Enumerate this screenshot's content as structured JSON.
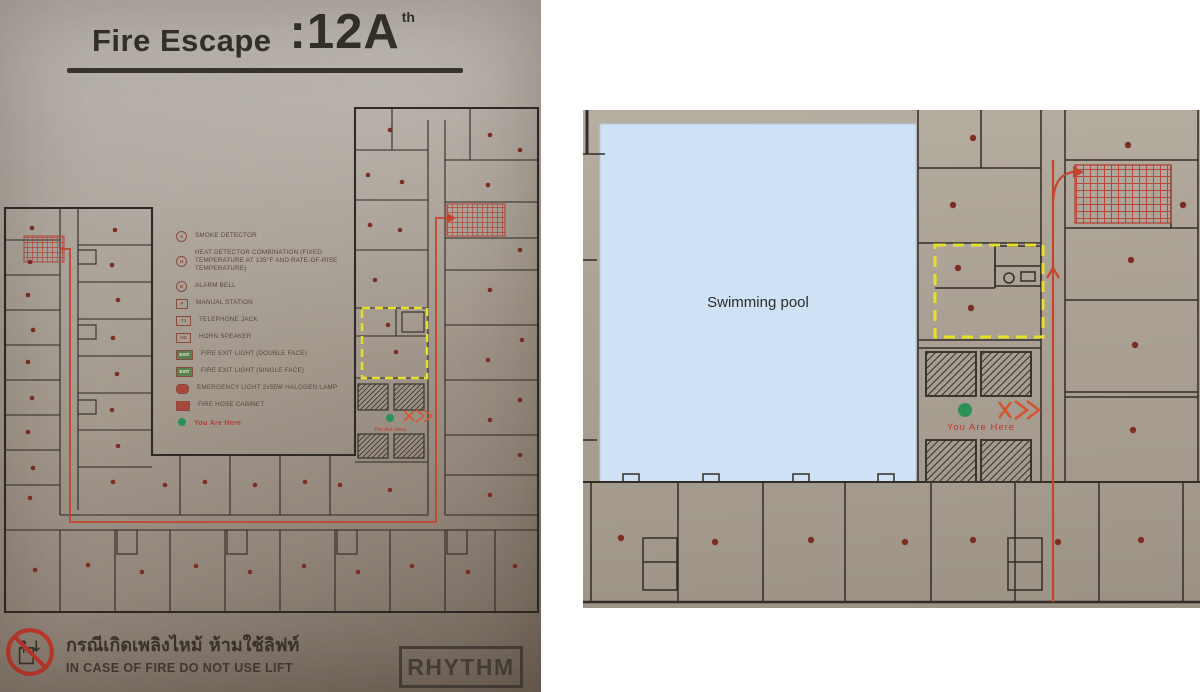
{
  "colors": {
    "route_red": "#c4452c",
    "highlight_yellow": "#e6df2e",
    "marker_green": "#2a9256",
    "detector_red": "#7e2d22",
    "pool_blue": "#cfe1f4"
  },
  "left_sign": {
    "title": "Fire Escape",
    "floor_number": ":12A",
    "floor_suffix": "th",
    "legend_items": [
      {
        "icon": "smoke-detector-icon",
        "glyph": "S",
        "label": "SMOKE DETECTOR"
      },
      {
        "icon": "heat-detector-icon",
        "glyph": "H",
        "label": "HEAT DETECTOR COMBINATION (FIXED TEMPERATURE AT 135°F AND RATE-OF-RISE TEMPERATURE)"
      },
      {
        "icon": "alarm-bell-icon",
        "glyph": "B",
        "label": "ALARM BELL"
      },
      {
        "icon": "manual-station-icon",
        "glyph": "F",
        "label": "MANUAL STATION"
      },
      {
        "icon": "telephone-jack-icon",
        "glyph": "TJ",
        "label": "TELEPHONE JACK"
      },
      {
        "icon": "horn-speaker-icon",
        "glyph": "HS",
        "label": "HORN SPEAKER"
      },
      {
        "icon": "fire-exit-light-double-icon",
        "glyph": "EXIT",
        "label": "FIRE EXIT LIGHT (DOUBLE FACE)"
      },
      {
        "icon": "fire-exit-light-single-icon",
        "glyph": "EXIT",
        "label": "FIRE EXIT LIGHT (SINGLE FACE)"
      },
      {
        "icon": "emergency-light-icon",
        "glyph": "",
        "label": "EMERGENCY LIGHT 2x55W HALOGEN LAMP"
      },
      {
        "icon": "fire-hose-cabinet-icon",
        "glyph": "",
        "label": "FIRE HOSE CABINET"
      },
      {
        "icon": "you-are-here-icon",
        "glyph": "",
        "label": "You Are Here"
      }
    ],
    "plan_you_are_here": "You Are Here",
    "warning_thai": "กรณีเกิดเพลิงไหม้ ห้ามใช้ลิฟท์",
    "warning_english": "IN CASE OF FIRE DO NOT USE LIFT",
    "brand": "RHYTHM",
    "smoke_detector_positions": [
      [
        32,
        138
      ],
      [
        30,
        172
      ],
      [
        28,
        205
      ],
      [
        33,
        240
      ],
      [
        28,
        272
      ],
      [
        32,
        308
      ],
      [
        28,
        342
      ],
      [
        33,
        378
      ],
      [
        30,
        408
      ],
      [
        115,
        140
      ],
      [
        112,
        175
      ],
      [
        118,
        210
      ],
      [
        113,
        248
      ],
      [
        117,
        284
      ],
      [
        112,
        320
      ],
      [
        118,
        356
      ],
      [
        113,
        392
      ],
      [
        390,
        40
      ],
      [
        368,
        85
      ],
      [
        402,
        92
      ],
      [
        370,
        135
      ],
      [
        400,
        140
      ],
      [
        375,
        190
      ],
      [
        388,
        235
      ],
      [
        396,
        262
      ],
      [
        390,
        400
      ],
      [
        490,
        45
      ],
      [
        520,
        60
      ],
      [
        488,
        95
      ],
      [
        520,
        160
      ],
      [
        490,
        200
      ],
      [
        522,
        250
      ],
      [
        488,
        270
      ],
      [
        520,
        310
      ],
      [
        490,
        330
      ],
      [
        520,
        365
      ],
      [
        490,
        405
      ],
      [
        165,
        395
      ],
      [
        205,
        392
      ],
      [
        255,
        395
      ],
      [
        305,
        392
      ],
      [
        340,
        395
      ],
      [
        35,
        480
      ],
      [
        88,
        475
      ],
      [
        142,
        482
      ],
      [
        196,
        476
      ],
      [
        250,
        482
      ],
      [
        304,
        476
      ],
      [
        358,
        482
      ],
      [
        412,
        476
      ],
      [
        468,
        482
      ],
      [
        515,
        476
      ]
    ]
  },
  "right_detail": {
    "pool_label": "Swimming pool",
    "you_are_here": "You Are Here",
    "smoke_detector_positions": [
      [
        38,
        428
      ],
      [
        132,
        432
      ],
      [
        228,
        430
      ],
      [
        322,
        432
      ],
      [
        390,
        430
      ],
      [
        475,
        432
      ],
      [
        558,
        430
      ],
      [
        390,
        28
      ],
      [
        370,
        95
      ],
      [
        375,
        158
      ],
      [
        388,
        198
      ],
      [
        545,
        35
      ],
      [
        548,
        150
      ],
      [
        552,
        235
      ],
      [
        550,
        320
      ],
      [
        600,
        95
      ]
    ]
  }
}
